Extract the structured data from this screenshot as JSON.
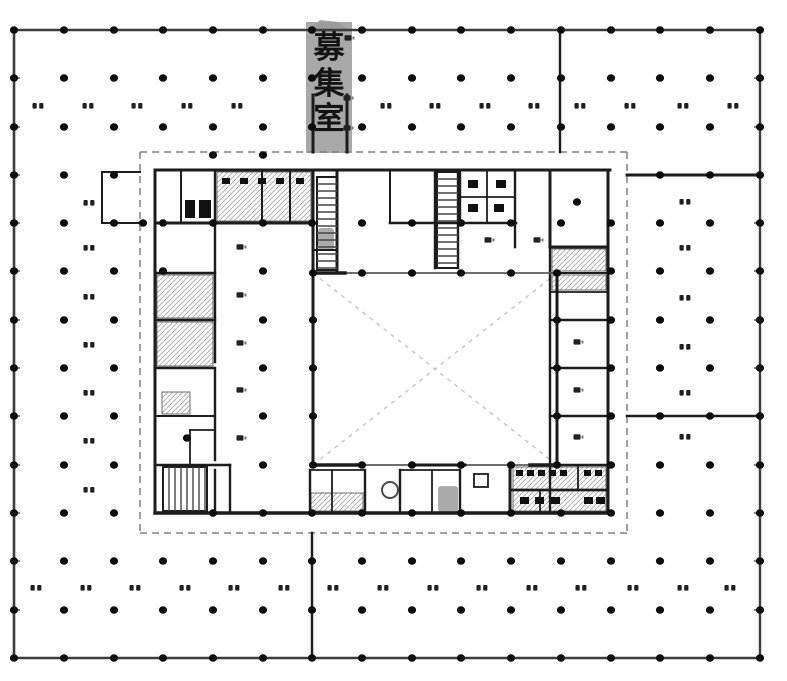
{
  "band": {
    "label": "募集室",
    "chars": [
      "募",
      "集",
      "室"
    ],
    "x": 306,
    "y": 22,
    "w": 46,
    "h": 131,
    "cap": "306,32 320,20 338,22 352,32",
    "color": "#9c9c9c",
    "cx": 329,
    "cys": [
      58,
      94,
      129
    ],
    "fs": 31,
    "text_color": "#141414"
  },
  "canvas": {
    "w": 787,
    "h": 681,
    "bg": "#fefefe",
    "ink": "#1c1c1c",
    "wall_gray": "#5a5a5a",
    "outer": "#3c3c3c",
    "light": "#c2c2c2",
    "dash_gray": "#808080",
    "hatch": "#a8a8a8",
    "mark": "#1f1f1f"
  },
  "grid": {
    "cols": [
      14,
      64,
      114,
      163,
      213,
      263,
      312,
      362,
      412,
      461,
      511,
      561,
      611,
      660,
      710,
      760
    ],
    "rows": [
      30,
      78,
      127,
      175,
      223,
      271,
      320,
      368,
      416,
      465,
      513,
      561,
      610,
      658
    ],
    "dot_rx": 4.1,
    "dot_ry": 3.7,
    "exclude": [
      145,
      154,
      631,
      531
    ],
    "include": [
      [
        213,
        155
      ],
      [
        263,
        155
      ],
      [
        143,
        223
      ],
      [
        163,
        223
      ],
      [
        213,
        223
      ],
      [
        263,
        223
      ],
      [
        312,
        223
      ],
      [
        362,
        223
      ],
      [
        412,
        223
      ],
      [
        461,
        223
      ],
      [
        511,
        223
      ],
      [
        561,
        223
      ],
      [
        611,
        223
      ],
      [
        163,
        271
      ],
      [
        263,
        271
      ],
      [
        611,
        271
      ],
      [
        313,
        273
      ],
      [
        362,
        273
      ],
      [
        412,
        273
      ],
      [
        461,
        273
      ],
      [
        511,
        273
      ],
      [
        557,
        273
      ],
      [
        263,
        320
      ],
      [
        313,
        320
      ],
      [
        557,
        320
      ],
      [
        611,
        320
      ],
      [
        263,
        368
      ],
      [
        313,
        368
      ],
      [
        557,
        368
      ],
      [
        611,
        368
      ],
      [
        263,
        416
      ],
      [
        313,
        416
      ],
      [
        557,
        416
      ],
      [
        611,
        416
      ],
      [
        263,
        465
      ],
      [
        313,
        465
      ],
      [
        362,
        465
      ],
      [
        412,
        465
      ],
      [
        461,
        465
      ],
      [
        511,
        465
      ],
      [
        557,
        465
      ],
      [
        611,
        465
      ],
      [
        213,
        513
      ],
      [
        263,
        513
      ],
      [
        312,
        513
      ],
      [
        362,
        513
      ],
      [
        412,
        513
      ],
      [
        461,
        513
      ],
      [
        511,
        513
      ],
      [
        561,
        513
      ],
      [
        611,
        513
      ],
      [
        577,
        202
      ],
      [
        187,
        438
      ]
    ]
  },
  "walls": [
    [
      14,
      30,
      760,
      30,
      2.4,
      "o"
    ],
    [
      14,
      658,
      760,
      658,
      2.6,
      "o"
    ],
    [
      14,
      30,
      14,
      658,
      2.6,
      "o"
    ],
    [
      760,
      30,
      760,
      658,
      2.4,
      "o"
    ],
    [
      560,
      30,
      560,
      152,
      2.4
    ],
    [
      627,
      175,
      760,
      175,
      3
    ],
    [
      627,
      416,
      760,
      416,
      2.6
    ],
    [
      312,
      533,
      312,
      658,
      2.4
    ],
    [
      102,
      172,
      102,
      223,
      2
    ],
    [
      102,
      172,
      140,
      172,
      2
    ],
    [
      102,
      223,
      140,
      223,
      2
    ],
    [
      313,
      95,
      313,
      152,
      3
    ],
    [
      347,
      95,
      347,
      152,
      3
    ],
    [
      155,
      170,
      610,
      170,
      3
    ],
    [
      155,
      170,
      155,
      513,
      3
    ],
    [
      608,
      170,
      608,
      513,
      3
    ],
    [
      155,
      513,
      611,
      513,
      3.5
    ],
    [
      155,
      223,
      313,
      223,
      3
    ],
    [
      390,
      223,
      516,
      223,
      2.6
    ],
    [
      181,
      172,
      181,
      223,
      2
    ],
    [
      215,
      170,
      215,
      223,
      2.4
    ],
    [
      262,
      172,
      262,
      223,
      2
    ],
    [
      290,
      172,
      290,
      223,
      2
    ],
    [
      313,
      170,
      313,
      273,
      3
    ],
    [
      337,
      170,
      337,
      273,
      3
    ],
    [
      313,
      250,
      337,
      250,
      2
    ],
    [
      390,
      172,
      390,
      223,
      2
    ],
    [
      435,
      172,
      435,
      268,
      2.4
    ],
    [
      458,
      172,
      458,
      268,
      2.4
    ],
    [
      435,
      268,
      458,
      268,
      2
    ],
    [
      460,
      172,
      460,
      223,
      2.4
    ],
    [
      515,
      172,
      515,
      247,
      2.4
    ],
    [
      487,
      172,
      487,
      223,
      1.8
    ],
    [
      460,
      197,
      515,
      197,
      1.8
    ],
    [
      550,
      170,
      550,
      247,
      3
    ],
    [
      550,
      247,
      608,
      247,
      3
    ],
    [
      215,
      223,
      215,
      362,
      2.4
    ],
    [
      215,
      370,
      215,
      460,
      2.4
    ],
    [
      215,
      470,
      215,
      513,
      2.4
    ],
    [
      155,
      273,
      215,
      273,
      2.4
    ],
    [
      155,
      320,
      215,
      320,
      2.4
    ],
    [
      155,
      368,
      215,
      368,
      2.4
    ],
    [
      155,
      416,
      215,
      416,
      2
    ],
    [
      155,
      465,
      230,
      465,
      2.6
    ],
    [
      230,
      465,
      230,
      513,
      2.4
    ],
    [
      190,
      430,
      215,
      430,
      1.8
    ],
    [
      190,
      430,
      190,
      465,
      1.8
    ],
    [
      550,
      247,
      550,
      513,
      2.4
    ],
    [
      550,
      273,
      608,
      273,
      2
    ],
    [
      550,
      292,
      608,
      292,
      1.8
    ],
    [
      550,
      320,
      608,
      320,
      2.4
    ],
    [
      550,
      368,
      608,
      368,
      2.4
    ],
    [
      550,
      416,
      608,
      416,
      2.4
    ],
    [
      550,
      465,
      611,
      465,
      2.6
    ],
    [
      310,
      470,
      310,
      513,
      2.4
    ],
    [
      332,
      470,
      332,
      513,
      1.8
    ],
    [
      365,
      470,
      365,
      513,
      2.4
    ],
    [
      310,
      470,
      365,
      470,
      1.8
    ],
    [
      400,
      470,
      400,
      513,
      2.4
    ],
    [
      400,
      470,
      460,
      470,
      1.8
    ],
    [
      432,
      470,
      432,
      513,
      1.8
    ],
    [
      460,
      470,
      460,
      513,
      2.4
    ],
    [
      510,
      465,
      510,
      513,
      3
    ],
    [
      540,
      490,
      540,
      513,
      1.8
    ],
    [
      578,
      465,
      578,
      490,
      1.8
    ],
    [
      510,
      490,
      608,
      490,
      2.8
    ],
    [
      313,
      273,
      313,
      465,
      3
    ],
    [
      557,
      273,
      557,
      465,
      3
    ],
    [
      313,
      273,
      557,
      273,
      1.8,
      "g"
    ],
    [
      313,
      465,
      557,
      465,
      1.8,
      "g"
    ],
    [
      313,
      273,
      345,
      273,
      3.5
    ],
    [
      313,
      465,
      360,
      465,
      3.5
    ],
    [
      412,
      465,
      465,
      465,
      3
    ],
    [
      530,
      465,
      557,
      465,
      3.5
    ]
  ],
  "dashed": [
    [
      140,
      152,
      627,
      152,
      1.5,
      "#808080",
      "7,5"
    ],
    [
      140,
      533,
      627,
      533,
      1.5,
      "#808080",
      "7,5"
    ],
    [
      140,
      152,
      140,
      533,
      1.5,
      "#808080",
      "7,5"
    ],
    [
      627,
      152,
      627,
      533,
      1.5,
      "#808080",
      "7,5"
    ],
    [
      313,
      273,
      557,
      465,
      1.3,
      "#c2c2c2",
      "4,5"
    ],
    [
      557,
      273,
      313,
      465,
      1.3,
      "#c2c2c2",
      "4,5"
    ]
  ],
  "hatch_rects": [
    [
      217,
      172,
      94,
      49
    ],
    [
      157,
      275,
      56,
      43
    ],
    [
      157,
      322,
      56,
      44
    ],
    [
      162,
      392,
      28,
      22
    ],
    [
      552,
      249,
      54,
      22
    ],
    [
      552,
      275,
      54,
      15
    ],
    [
      513,
      467,
      93,
      44
    ],
    [
      311,
      493,
      52,
      18
    ]
  ],
  "outline_rects": [
    [
      474,
      474,
      14,
      13,
      1.8
    ]
  ],
  "fixtures": [
    [
      185,
      200,
      10,
      18
    ],
    [
      199,
      200,
      12,
      18
    ],
    [
      222,
      178,
      8,
      6
    ],
    [
      240,
      178,
      8,
      6
    ],
    [
      258,
      178,
      8,
      6
    ],
    [
      276,
      178,
      8,
      6
    ],
    [
      296,
      178,
      8,
      6
    ],
    [
      468,
      180,
      10,
      8
    ],
    [
      496,
      180,
      10,
      8
    ],
    [
      468,
      204,
      10,
      8
    ],
    [
      494,
      204,
      10,
      8
    ],
    [
      516,
      470,
      7,
      6
    ],
    [
      527,
      470,
      7,
      6
    ],
    [
      538,
      470,
      7,
      6
    ],
    [
      549,
      470,
      7,
      6
    ],
    [
      560,
      470,
      7,
      6
    ],
    [
      584,
      470,
      7,
      6
    ],
    [
      595,
      470,
      7,
      6
    ],
    [
      520,
      497,
      9,
      7
    ],
    [
      535,
      497,
      9,
      7
    ],
    [
      551,
      497,
      9,
      7
    ],
    [
      584,
      497,
      9,
      7
    ],
    [
      596,
      497,
      9,
      7
    ]
  ],
  "gray_blobs": [
    [
      438,
      486,
      20,
      26
    ],
    [
      318,
      228,
      16,
      22
    ]
  ],
  "circles": [
    [
      390,
      490,
      8
    ]
  ],
  "stairs": [
    {
      "x": 317,
      "y": 177,
      "w": 20,
      "h": 93,
      "dir": "h",
      "step": 7
    },
    {
      "x": 437,
      "y": 172,
      "w": 21,
      "h": 96,
      "dir": "h",
      "step": 7
    },
    {
      "x": 163,
      "y": 467,
      "w": 44,
      "h": 44,
      "dir": "v",
      "step": 6
    }
  ],
  "dim_marks": [
    [
      38,
      106
    ],
    [
      88,
      106
    ],
    [
      137,
      106
    ],
    [
      187,
      106
    ],
    [
      237,
      106
    ],
    [
      386,
      106
    ],
    [
      435,
      106
    ],
    [
      485,
      106
    ],
    [
      534,
      106
    ],
    [
      580,
      106
    ],
    [
      630,
      106
    ],
    [
      683,
      106
    ],
    [
      733,
      106
    ],
    [
      89,
      203
    ],
    [
      89,
      248
    ],
    [
      89,
      297
    ],
    [
      89,
      345
    ],
    [
      89,
      393
    ],
    [
      89,
      441
    ],
    [
      89,
      490
    ],
    [
      685,
      202
    ],
    [
      685,
      248
    ],
    [
      685,
      298
    ],
    [
      685,
      347
    ],
    [
      685,
      393
    ],
    [
      685,
      437
    ],
    [
      36,
      588
    ],
    [
      86,
      588
    ],
    [
      135,
      588
    ],
    [
      185,
      588
    ],
    [
      234,
      588
    ],
    [
      284,
      588
    ],
    [
      333,
      588
    ],
    [
      383,
      588
    ],
    [
      433,
      588
    ],
    [
      482,
      588
    ],
    [
      532,
      588
    ],
    [
      581,
      588
    ],
    [
      633,
      588
    ],
    [
      683,
      588
    ],
    [
      730,
      588
    ]
  ],
  "room_marks": [
    [
      240,
      247
    ],
    [
      240,
      295
    ],
    [
      240,
      343
    ],
    [
      240,
      390
    ],
    [
      240,
      438
    ],
    [
      577,
      342
    ],
    [
      577,
      390
    ],
    [
      577,
      437
    ],
    [
      488,
      240
    ],
    [
      537,
      240
    ],
    [
      348,
      38
    ],
    [
      347,
      98
    ],
    [
      347,
      128
    ]
  ]
}
